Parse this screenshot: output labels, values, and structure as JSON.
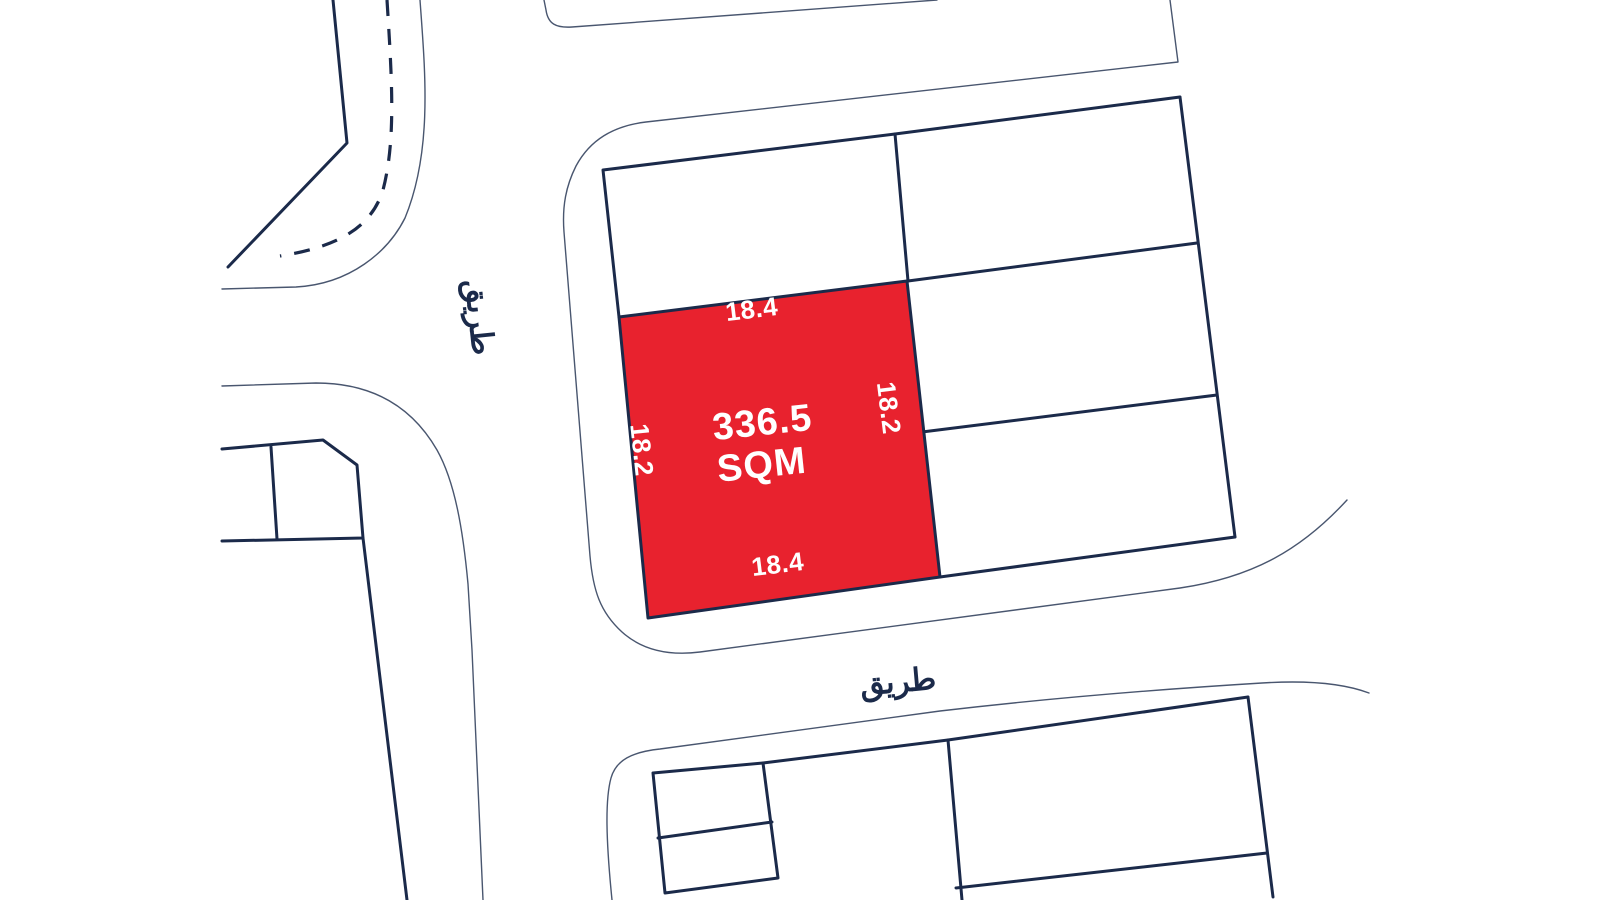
{
  "map": {
    "highlighted_plot": {
      "area_value": "336.5",
      "area_unit": "SQM",
      "top_dimension": "18.4",
      "bottom_dimension": "18.4",
      "left_dimension": "18.2",
      "right_dimension": "18.2",
      "fill_color": "#E8222E"
    },
    "road_labels": {
      "left_road": "طريق",
      "bottom_road": "طريق"
    },
    "colors": {
      "background": "#FFFFFF",
      "line_dark": "#1B2A4A",
      "line_thin": "#49566F",
      "plot_label_text": "#FFFFFF"
    }
  },
  "geometry": {
    "red_plot_points": "619,317 907,281 940,577 648,618",
    "paths": {
      "topleft_road_outer_edge": "M 420,0 C 425,70 433,150 405,218 C 388,252 350,284 296,287 L 222,289",
      "topleft_road_inner_edge": "M 333,0 L 347,143 L 228,267",
      "topleft_road_centerline": "M 387,0 C 392,80 396,140 383,190 C 370,232 330,248 280,256",
      "junction_corner_curve": "M 222,386 L 316,383 C 370,383 411,405 437,450 C 455,482 463,530 468,584 L 472,650 L 483,900",
      "top_left_block_boundary": "M 544,0 L 546,10 C 548,24 556,28 572,27 L 937,0",
      "central_block_boundary": "M 1170,0 L 1178,62 L 646,122 C 613,126 590,140 576,166 C 566,186 562,206 564,232 L 590,556 C 593,590 600,612 622,632 C 642,650 668,656 700,652 L 1180,588 C 1254,577 1302,549 1347,500",
      "bottom_block_boundary": "M 612,900 C 606,840 605,800 611,778 C 616,760 632,752 660,749 L 940,711 C 1060,697 1180,688 1262,683 C 1310,680 1345,684 1369,693",
      "left_block_outline": "M 222,449 L 323,440 L 357,465 L 363,538 L 222,541",
      "left_block_divider": "M 271,447 L 277,539",
      "left_block_south_edge": "M 363,538 L 407,900",
      "central_upper_plot_edges": "M 619,317 L 603,170 L 895,134",
      "central_right_col_top_edge": "M 895,134 L 1180,97",
      "central_right_col_right_edge": "M 1180,97 L 1235,537",
      "central_vertical_divider": "M 895,134 L 908,281",
      "central_right_divider_1": "M 908,281 L 1197,243",
      "central_right_divider_2": "M 922,432 L 1217,395",
      "central_right_col_bottom_edge": "M 940,577 L 1235,537",
      "bottom_block_small_column": "M 653,773 L 763,763 L 778,878 L 665,893 Z",
      "bottom_block_small_divider": "M 658,838 L 772,822",
      "bottom_block_top_edge": "M 763,763 L 948,740 L 1248,697",
      "bottom_block_vertical_divider": "M 948,740 L 962,900",
      "bottom_block_right_edge": "M 1248,697 L 1273,897",
      "bottom_block_right_divider": "M 956,888 L 1267,853"
    }
  }
}
